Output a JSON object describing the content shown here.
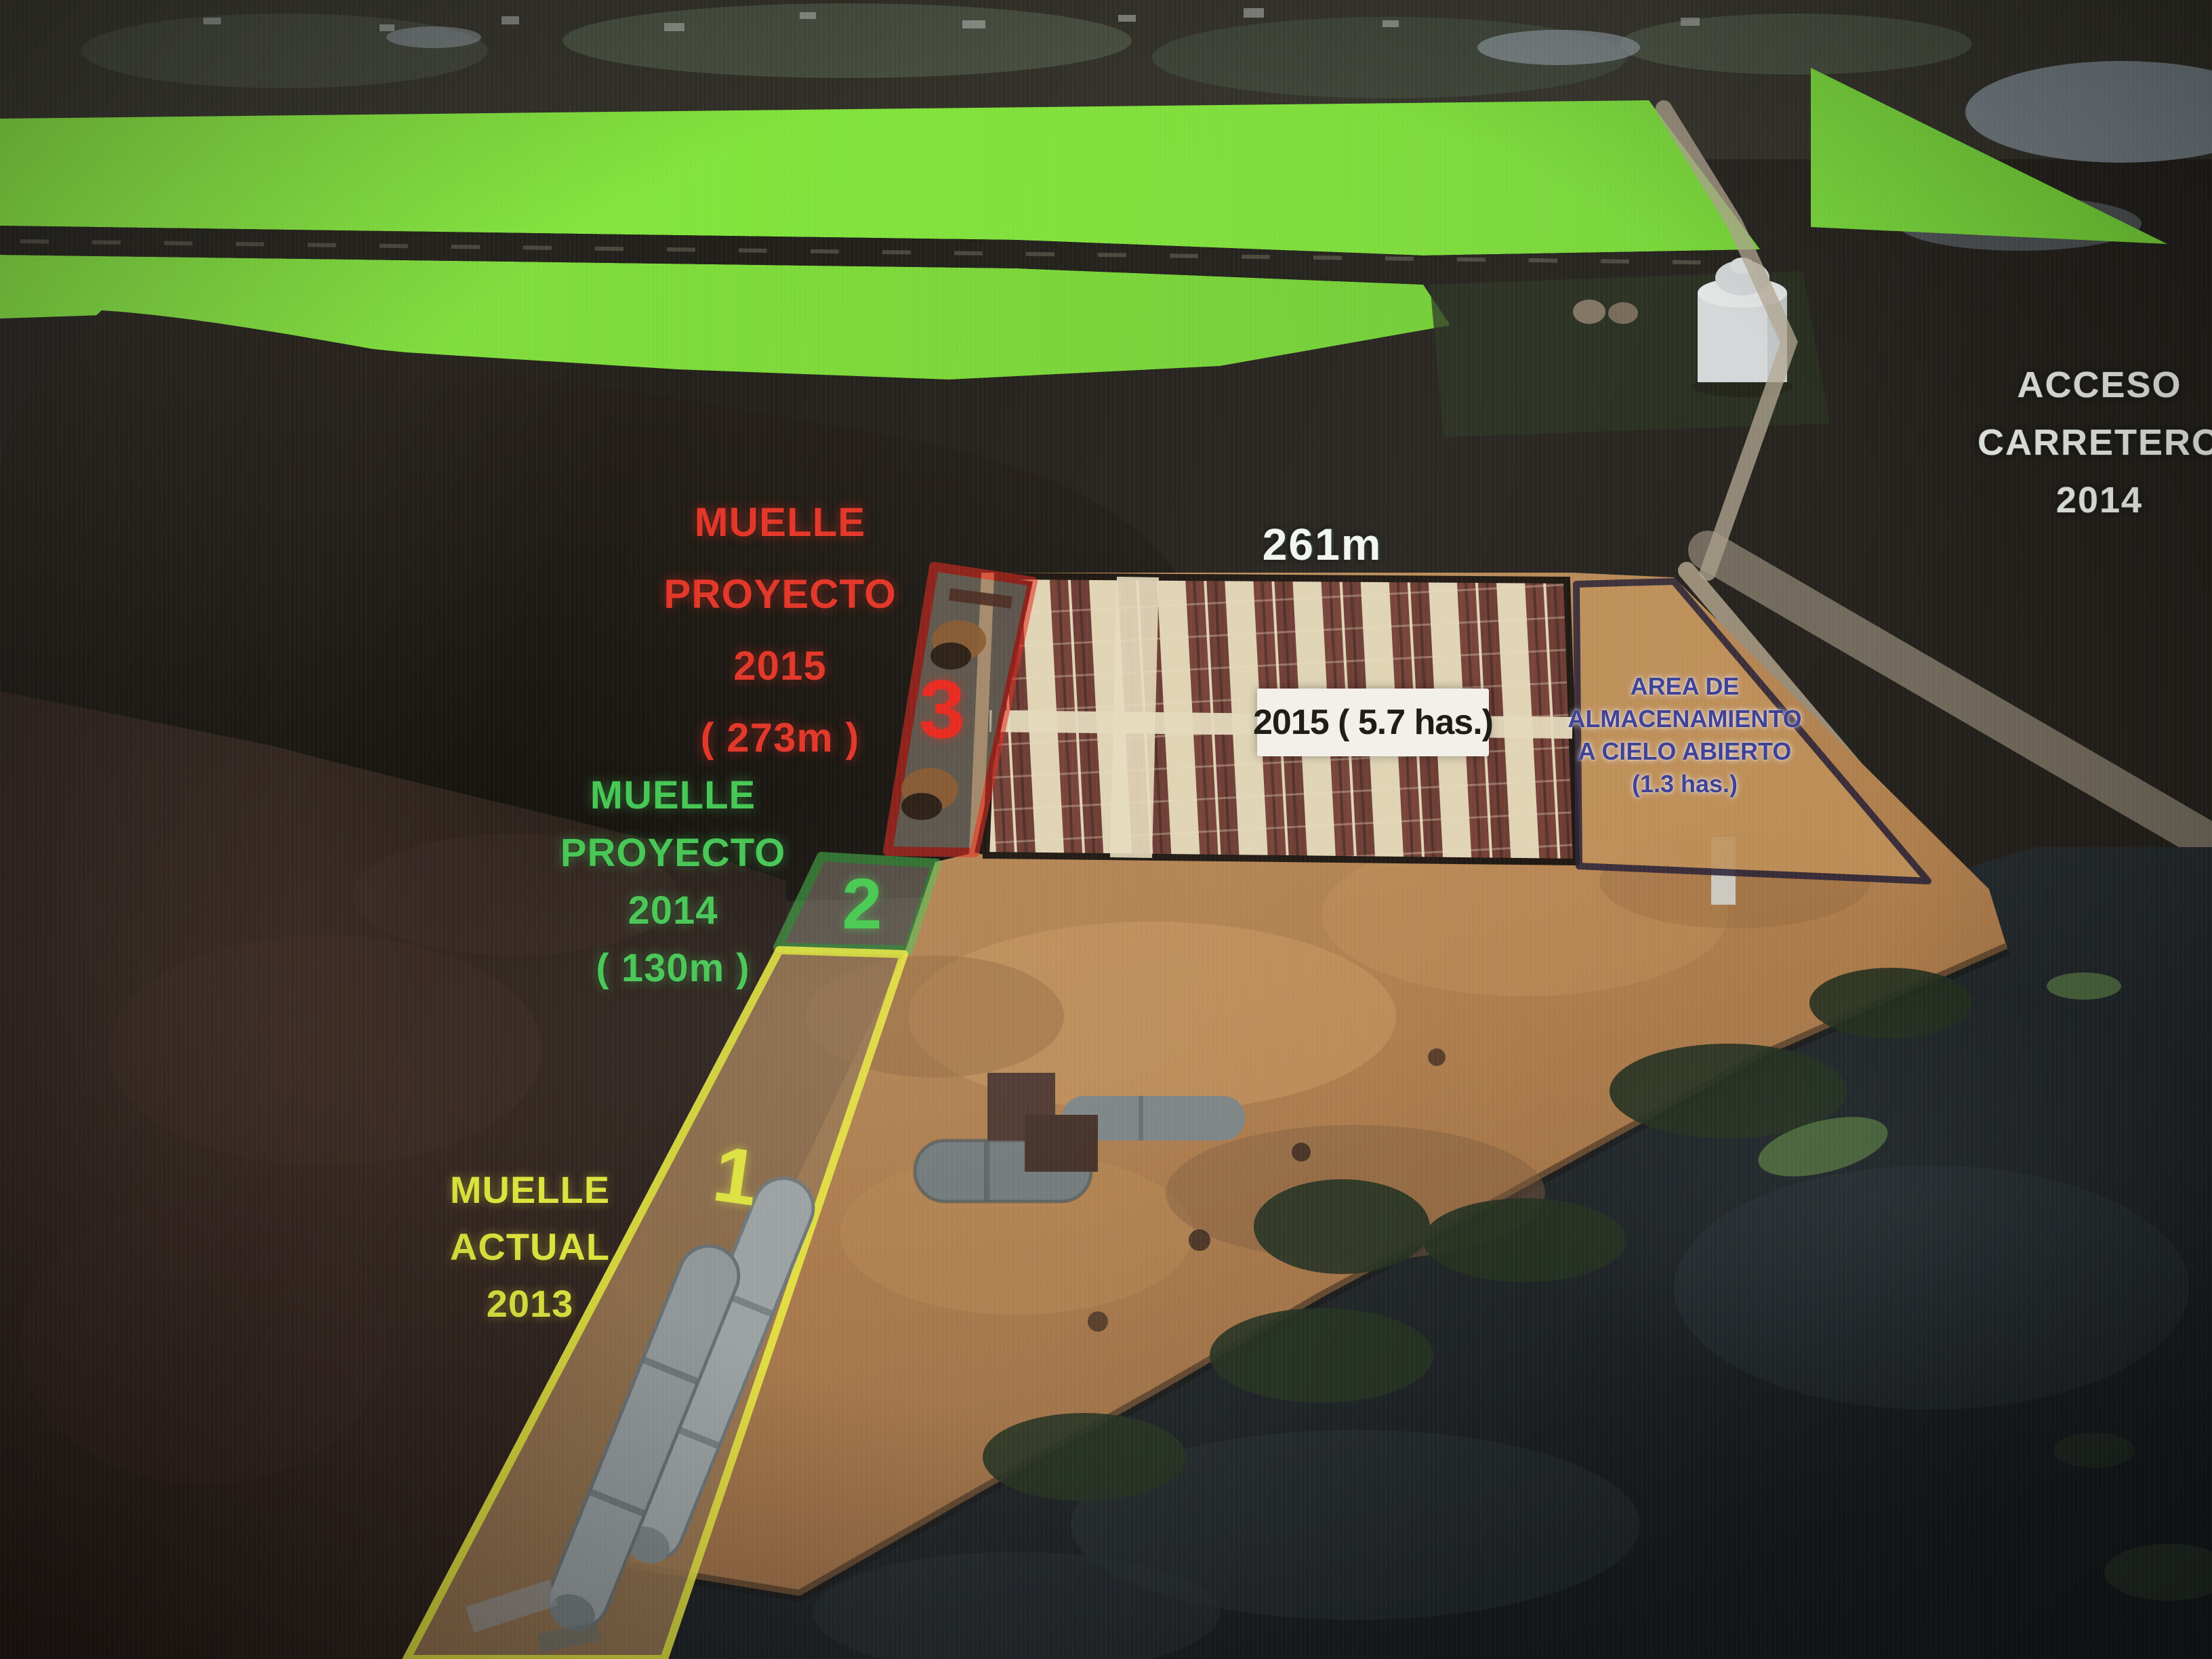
{
  "labels": {
    "muelle_proyecto_2015": {
      "lines": [
        "MUELLE",
        "PROYECTO",
        "2015",
        "( 273m )"
      ]
    },
    "muelle_proyecto_2014": {
      "lines": [
        "MUELLE",
        "PROYECTO",
        "2014",
        "( 130m )"
      ]
    },
    "muelle_actual_2013": {
      "lines": [
        "MUELLE",
        "ACTUAL",
        "2013"
      ]
    },
    "acceso_carretero": {
      "lines": [
        "ACCESO",
        "CARRETERO",
        "2014"
      ]
    },
    "quay_length": "261m",
    "yard_area": "2015 ( 5.7 has.)",
    "storage_area": {
      "lines": [
        "AREA DE",
        "ALMACENAMIENTO",
        "A CIELO ABIERTO",
        "(1.3 has.)"
      ]
    },
    "zone_numbers": {
      "zone3": "3",
      "zone2": "2",
      "zone1": "1"
    }
  },
  "colors": {
    "field_green": "#84e43d",
    "accent_red": "#e8281e",
    "accent_green": "#46c653",
    "accent_yellow": "#e9ea3e",
    "storage_text_blue": "#3c3f93",
    "storage_outline_navy": "#2a2236",
    "label_white": "#eef1ea",
    "platform_tan": "#b3834f"
  }
}
